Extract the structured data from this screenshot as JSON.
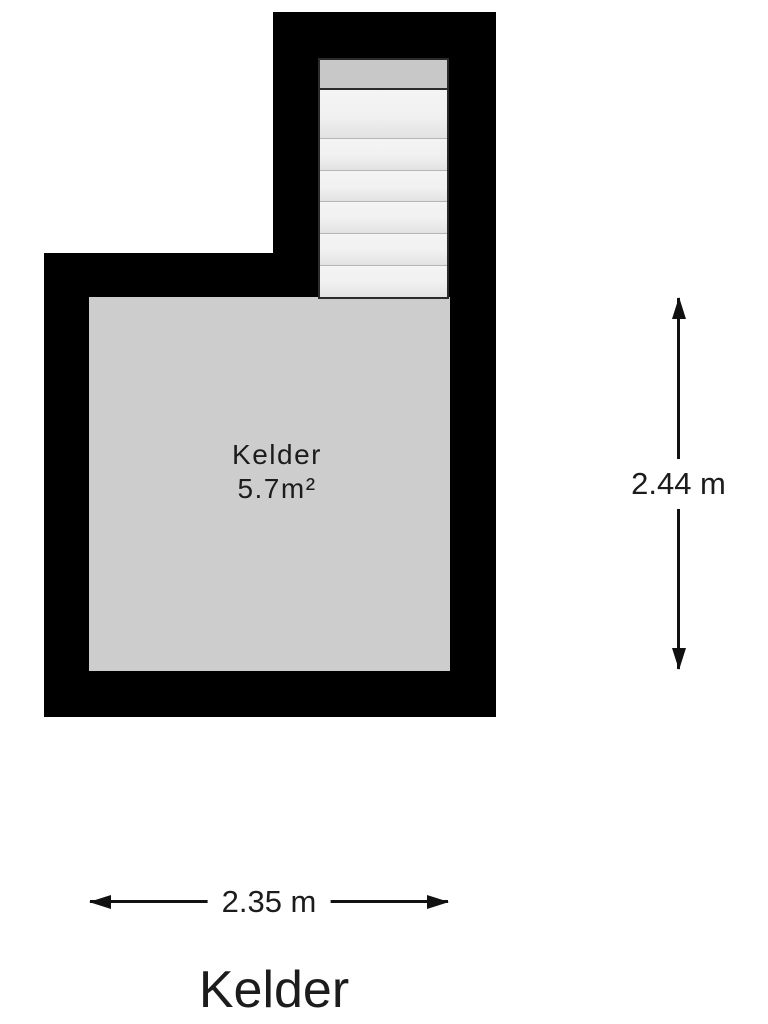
{
  "plan": {
    "room_label": {
      "name": "Kelder",
      "area": "5.7m²"
    },
    "stairs": {
      "step_count": 6
    },
    "dim_vertical": {
      "label": "2.44 m"
    },
    "dim_horizontal": {
      "label": "2.35 m"
    },
    "title": "Kelder",
    "colors": {
      "wall": "#000000",
      "floor": "#cdcdcd",
      "landing": "#c8c8c8",
      "tread": "#f0f0f0",
      "text": "#1c1c1c"
    }
  }
}
